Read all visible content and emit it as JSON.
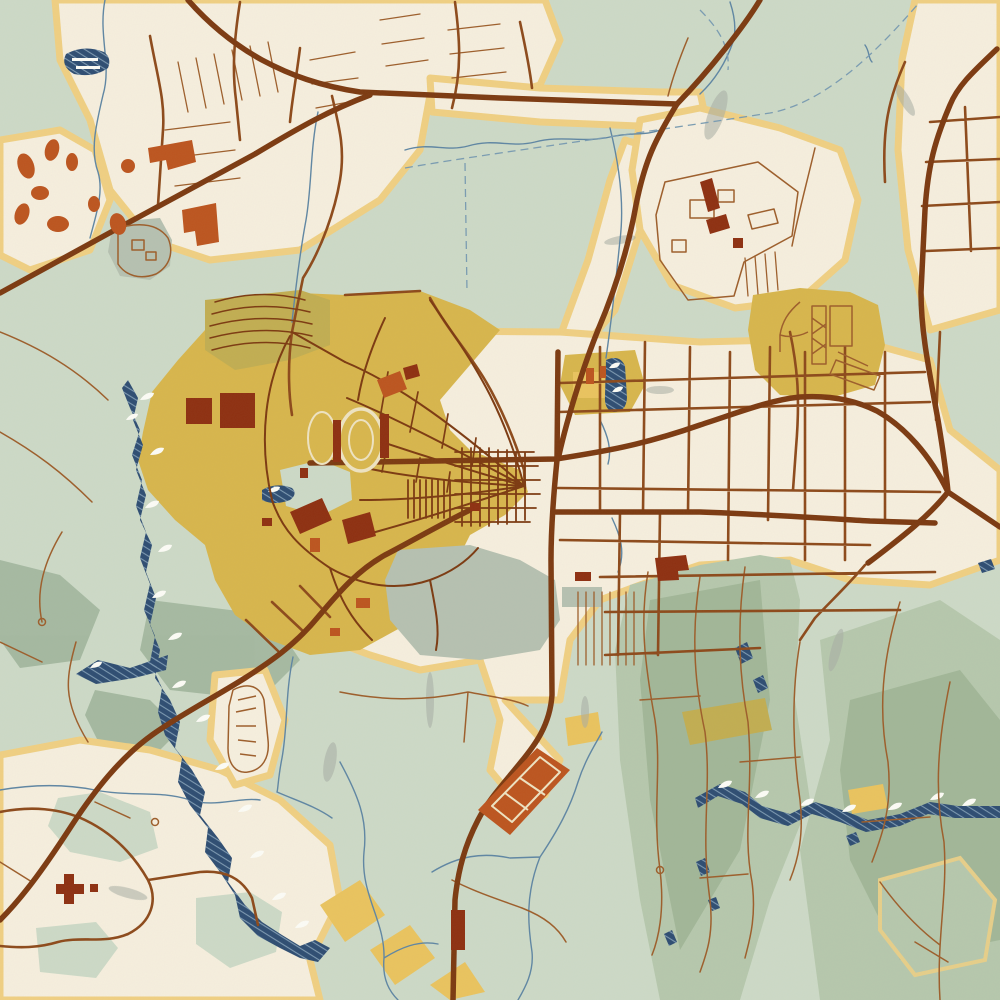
{
  "map": {
    "kind": "stylized-vintage-city-map",
    "canvas": {
      "width": 1000,
      "height": 1000
    },
    "palette": {
      "base_sage": "#cddac7",
      "urban": "#f6efde",
      "halo": "#f0d083",
      "mustard": "#d8b64d",
      "olive": "#c2ae52",
      "gold": "#eac45f",
      "gray_green": "#b6c1b1",
      "hill_mid": "#b6c8ad",
      "hill_dark": "#a2b798",
      "gorge_green": "#9fb49b",
      "water_dark": "#2e4d72",
      "water_line": "#5f86a3",
      "water_dash": "#7a9cb2",
      "hatch_line": "#8fabc0",
      "foam": "#fcfcf6",
      "road_major": "#7c3a11",
      "road_medium": "#8d4a1b",
      "road_minor": "#9d5e2b",
      "bldg_red": "#8e3011",
      "bldg_rust": "#bc551f",
      "track_cream": "#eee3c2",
      "streak": "#a8aea4"
    },
    "features": {
      "terrain": [
        "sage-plains",
        "foothill-ridges",
        "plateau",
        "gray-scrub-streaks"
      ],
      "water": [
        "river-gorge-with-wave-hatching",
        "foothill-creek",
        "reservoir-pond",
        "park-pond",
        "streams",
        "survey-dashed-lines"
      ],
      "roads": [
        "north-highway",
        "northeast-highway",
        "east-bypass",
        "main-east-west-artery",
        "second-artery",
        "downtown-vertical-route",
        "southwest-diagonal-route",
        "grid-streets",
        "suburb-loops",
        "foothill-trails"
      ],
      "landmarks": [
        "stadium-track-oval",
        "practice-field-oval",
        "campus-quad-fan",
        "campus-terraced-arcs",
        "dormitory-blocks",
        "fieldhouse-buildings",
        "shopping-mall-buildings",
        "industrial-park",
        "fairgrounds-grandstand",
        "feedlot-parallelogram",
        "oval-compound",
        "rural-cross-building"
      ]
    }
  }
}
